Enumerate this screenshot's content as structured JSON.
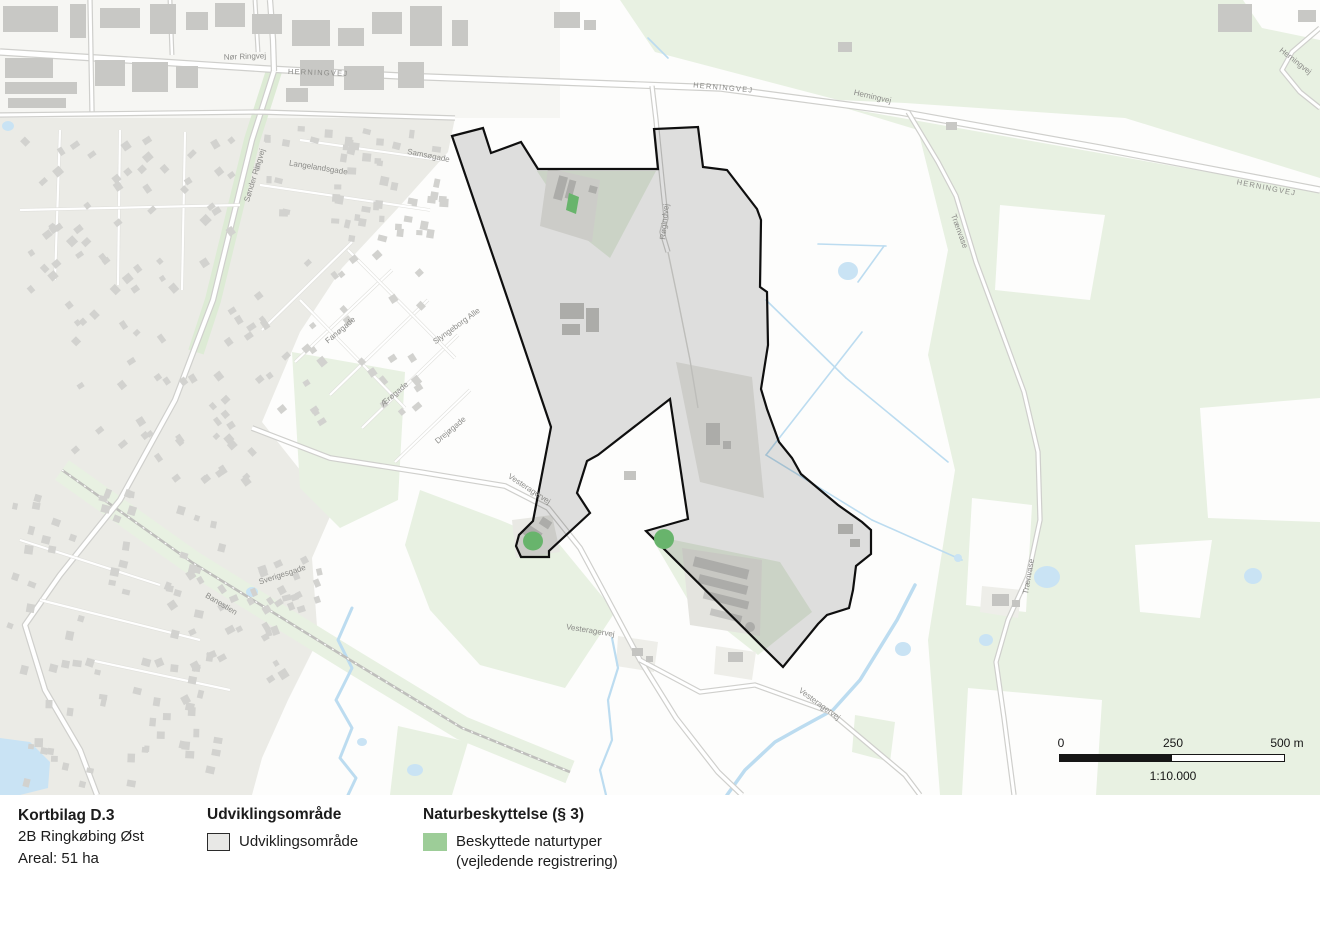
{
  "title_block": {
    "title": "Kortbilag D.3",
    "subtitle": "2B Ringkøbing Øst",
    "area_label": "Areal: 51 ha"
  },
  "legend": {
    "development": {
      "heading": "Udviklingsområde",
      "item": "Udviklingsområde",
      "swatch_fill": "#e8e8e6",
      "swatch_stroke": "#2b2b2b"
    },
    "nature": {
      "heading": "Naturbeskyttelse (§ 3)",
      "item_line1": "Beskyttede naturtyper",
      "item_line2": "(vejledende registrering)",
      "swatch_fill": "#9dcd98"
    }
  },
  "scale_bar": {
    "start_label": "0",
    "mid_label": "250",
    "end_label": "500 m",
    "ratio_label": "1:10.000"
  },
  "map": {
    "colors": {
      "development_fill": "#000000",
      "development_fill_opacity": 0.12,
      "development_stroke": "#0f0f0f",
      "nature_green": "#68b46c",
      "water": "#c9e3f4",
      "green_area": "#e8f1e2",
      "urban": "#ebebe6",
      "road_label": "#8b8b88"
    },
    "development_area": {
      "name": "Udviklingsområde 2B Ringkøbing Øst",
      "stroke_width": 2.2,
      "points": [
        [
          452,
          136
        ],
        [
          483,
          128
        ],
        [
          491,
          153
        ],
        [
          521,
          142
        ],
        [
          538,
          169
        ],
        [
          658,
          169
        ],
        [
          654,
          129
        ],
        [
          698,
          127
        ],
        [
          703,
          167
        ],
        [
          727,
          170
        ],
        [
          757,
          209
        ],
        [
          761,
          220
        ],
        [
          760,
          287
        ],
        [
          767,
          292
        ],
        [
          768,
          345
        ],
        [
          761,
          389
        ],
        [
          767,
          409
        ],
        [
          779,
          442
        ],
        [
          792,
          458
        ],
        [
          801,
          474
        ],
        [
          838,
          505
        ],
        [
          862,
          522
        ],
        [
          871,
          530
        ],
        [
          871,
          554
        ],
        [
          856,
          566
        ],
        [
          853,
          590
        ],
        [
          849,
          608
        ],
        [
          827,
          615
        ],
        [
          818,
          624
        ],
        [
          783,
          667
        ],
        [
          646,
          531
        ],
        [
          688,
          519
        ],
        [
          670,
          399
        ],
        [
          598,
          455
        ],
        [
          587,
          461
        ],
        [
          577,
          493
        ],
        [
          590,
          513
        ],
        [
          549,
          551
        ],
        [
          549,
          557
        ],
        [
          521,
          557
        ],
        [
          516,
          546
        ],
        [
          519,
          535
        ],
        [
          533,
          521
        ],
        [
          551,
          427
        ],
        [
          508,
          300
        ]
      ]
    },
    "nature_patches": [
      {
        "type": "polygon",
        "points": [
          [
            569,
            193
          ],
          [
            579,
            197
          ],
          [
            576,
            214
          ],
          [
            566,
            210
          ]
        ]
      },
      {
        "type": "ellipse",
        "cx": 533,
        "cy": 541,
        "rx": 10,
        "ry": 9.5
      },
      {
        "type": "ellipse",
        "cx": 664,
        "cy": 539,
        "rx": 10,
        "ry": 10
      }
    ],
    "labels": [
      {
        "text": "Nør Ringvej",
        "x": 245,
        "y": 59,
        "rot": -2,
        "size": 8,
        "sp": 0
      },
      {
        "text": "HERNINGVEJ",
        "x": 318,
        "y": 75,
        "rot": 2,
        "size": 7.5,
        "sp": 1.2
      },
      {
        "text": "HERNINGVEJ",
        "x": 723,
        "y": 90,
        "rot": 5,
        "size": 7.5,
        "sp": 1.2
      },
      {
        "text": "HERNINGVEJ",
        "x": 1266,
        "y": 190,
        "rot": 11,
        "size": 7.5,
        "sp": 1.2
      },
      {
        "text": "Herningvej",
        "x": 872,
        "y": 99,
        "rot": 13,
        "size": 8,
        "sp": 0
      },
      {
        "text": "Herningvej",
        "x": 1294,
        "y": 63,
        "rot": 38,
        "size": 8,
        "sp": 0
      },
      {
        "text": "Sønder Ringvej",
        "x": 257,
        "y": 176,
        "rot": -73,
        "size": 8,
        "sp": 0
      },
      {
        "text": "Langelandsgade",
        "x": 318,
        "y": 170,
        "rot": 9,
        "size": 8,
        "sp": 0
      },
      {
        "text": "Samsøgade",
        "x": 428,
        "y": 158,
        "rot": 11,
        "size": 8,
        "sp": 0
      },
      {
        "text": "Fanøgade",
        "x": 342,
        "y": 332,
        "rot": -40,
        "size": 8,
        "sp": 0
      },
      {
        "text": "Ærøgade",
        "x": 396,
        "y": 396,
        "rot": -40,
        "size": 8,
        "sp": 0
      },
      {
        "text": "Drejøgade",
        "x": 452,
        "y": 432,
        "rot": -40,
        "size": 8,
        "sp": 0
      },
      {
        "text": "Slyngeborg Alle",
        "x": 458,
        "y": 328,
        "rot": -36,
        "size": 8,
        "sp": 0
      },
      {
        "text": "Sverigesgade",
        "x": 283,
        "y": 577,
        "rot": -18,
        "size": 8,
        "sp": 0
      },
      {
        "text": "Banestien",
        "x": 220,
        "y": 606,
        "rot": 31,
        "size": 8,
        "sp": 0
      },
      {
        "text": "Vesteragervej",
        "x": 528,
        "y": 491,
        "rot": 33,
        "size": 8,
        "sp": 0
      },
      {
        "text": "Vesteragervej",
        "x": 590,
        "y": 633,
        "rot": 9,
        "size": 8,
        "sp": 0
      },
      {
        "text": "Vesteragervej",
        "x": 818,
        "y": 706,
        "rot": 36,
        "size": 8,
        "sp": 0
      },
      {
        "text": "Røgindvej",
        "x": 667,
        "y": 222,
        "rot": -84,
        "size": 8,
        "sp": 0
      },
      {
        "text": "Trænvase",
        "x": 1031,
        "y": 577,
        "rot": -80,
        "size": 8,
        "sp": 0
      },
      {
        "text": "Trænvase",
        "x": 957,
        "y": 232,
        "rot": 70,
        "size": 8,
        "sp": 0
      }
    ]
  }
}
